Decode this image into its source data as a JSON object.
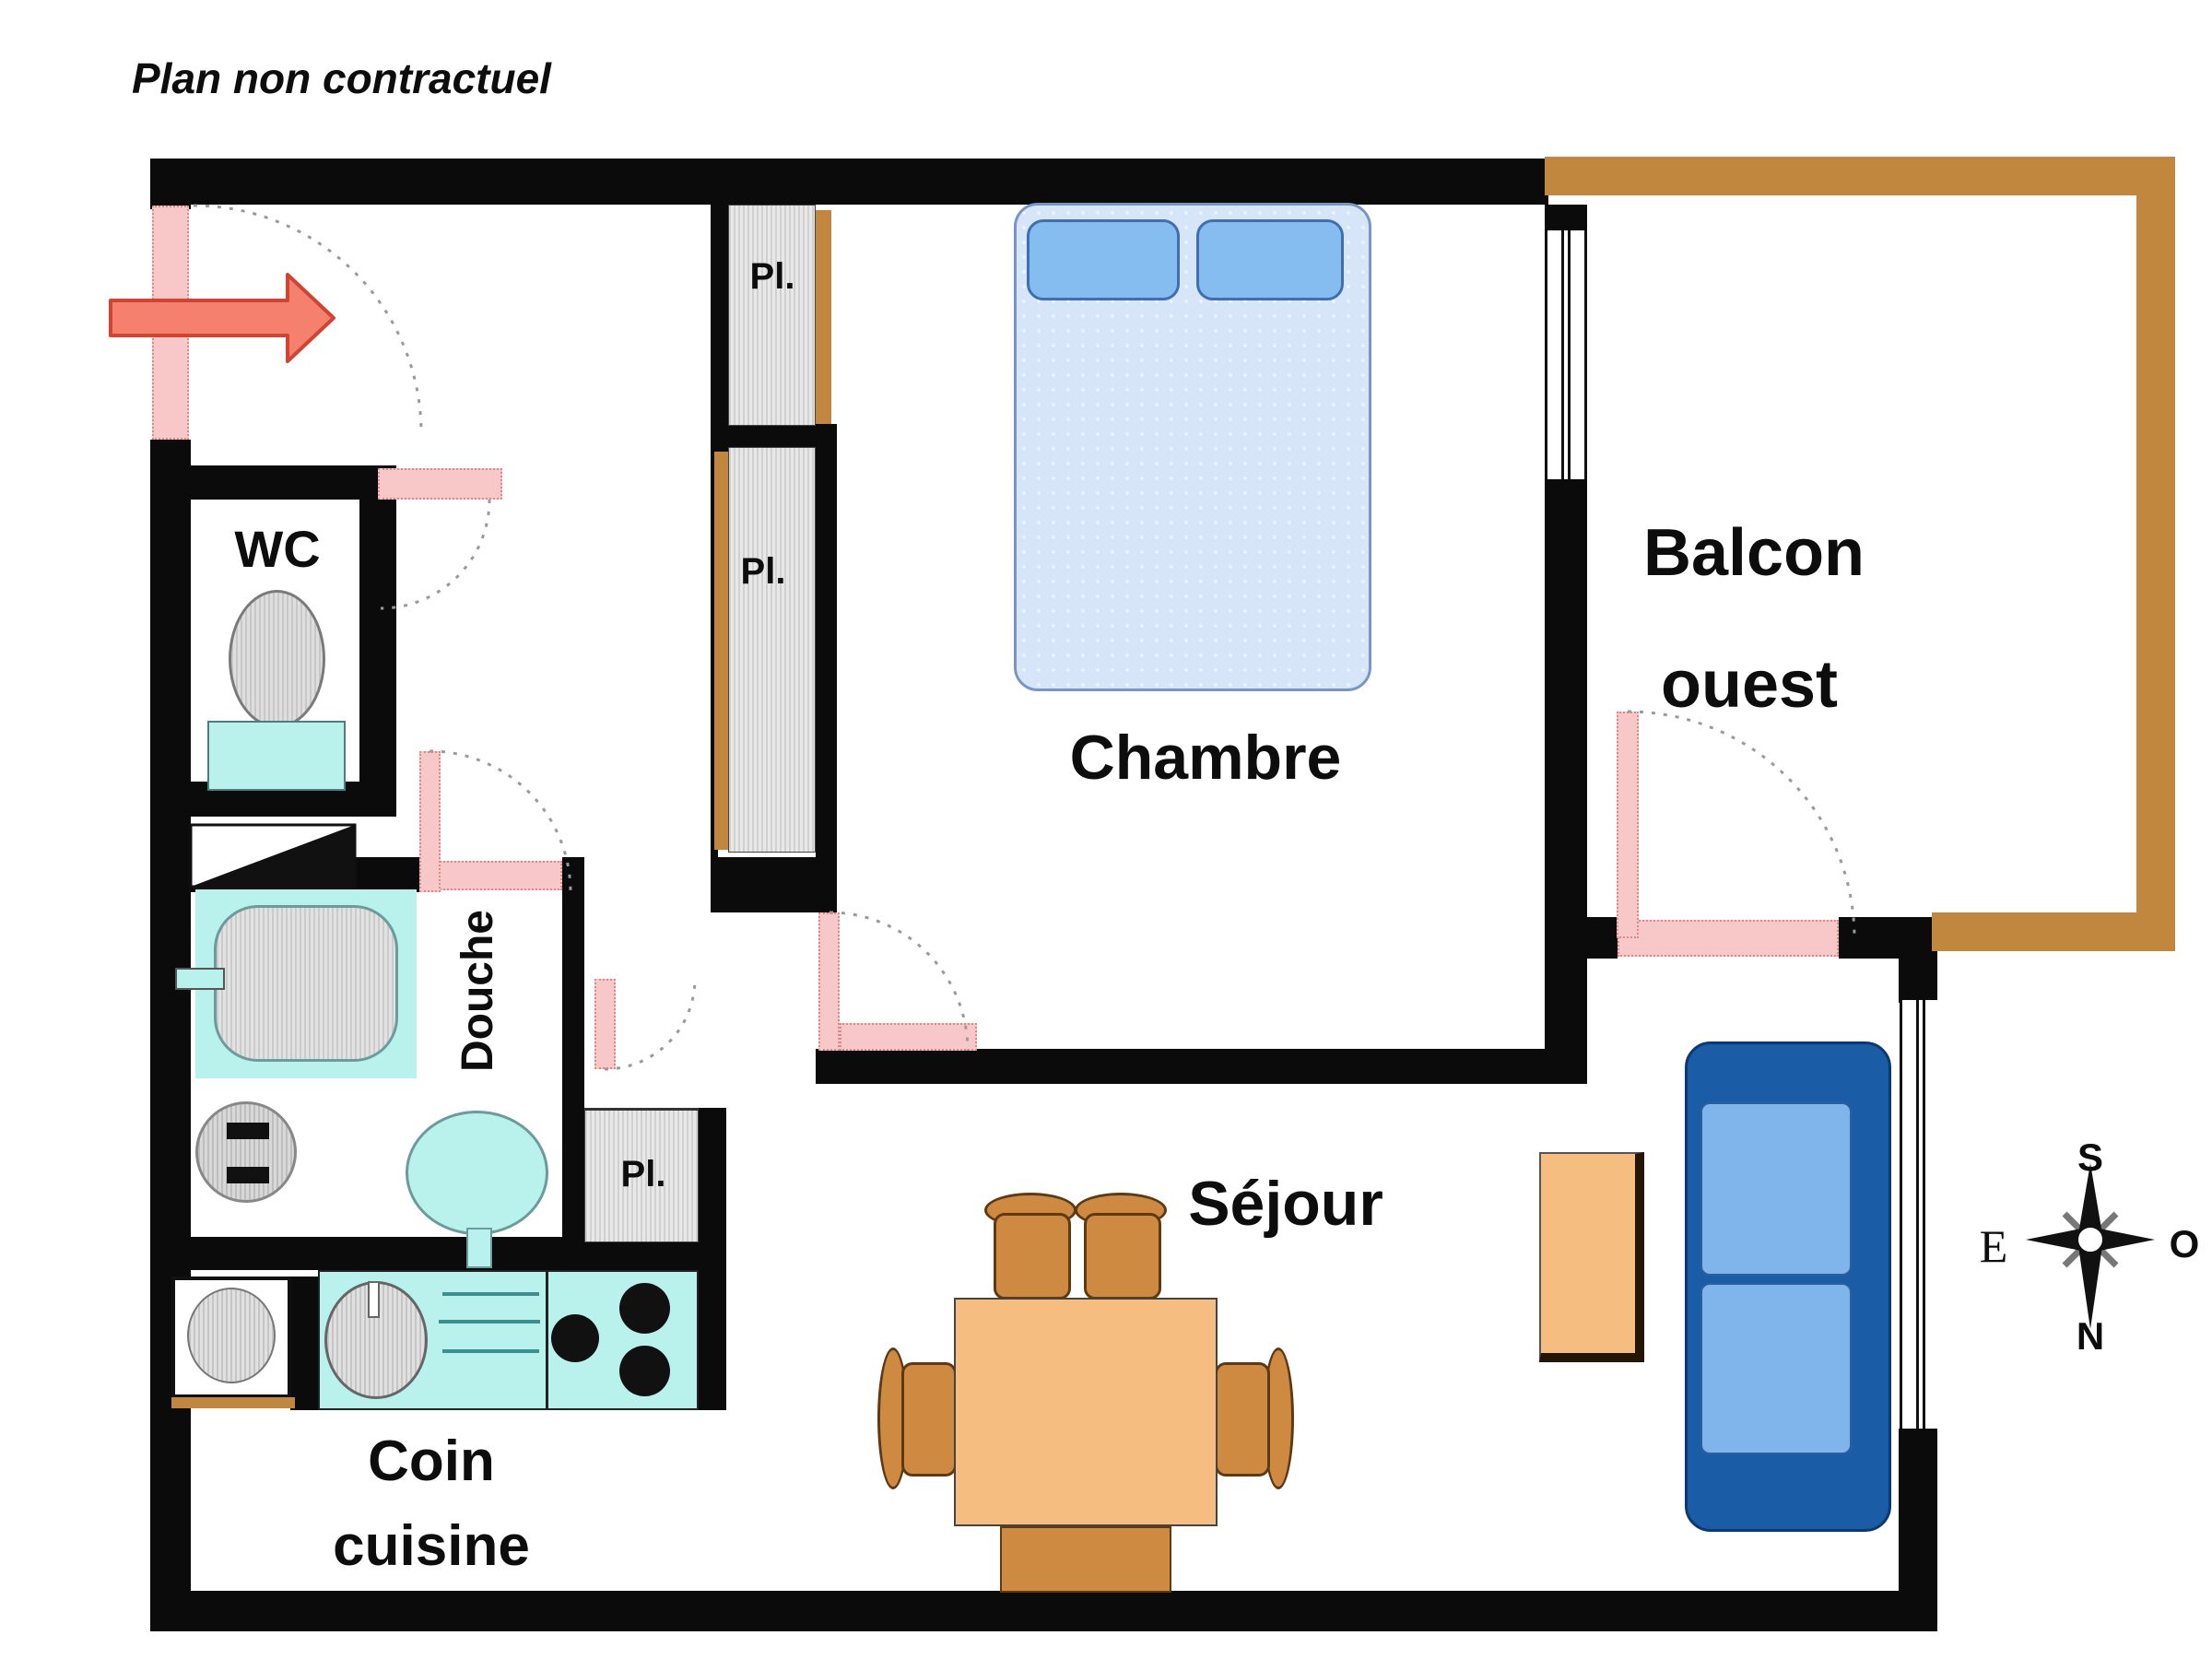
{
  "title": "Plan non contractuel",
  "rooms": {
    "wc": {
      "label": "WC"
    },
    "douche": {
      "label": "Douche"
    },
    "chambre": {
      "label": "Chambre"
    },
    "balcon": {
      "line1": "Balcon",
      "line2": "ouest"
    },
    "sejour": {
      "label": "Séjour"
    },
    "cuisine": {
      "line1": "Coin",
      "line2": "cuisine"
    }
  },
  "closets": {
    "entry_upper": "Pl.",
    "entry_lower": "Pl.",
    "sejour_small": "Pl."
  },
  "compass": {
    "south": "S",
    "north": "N",
    "east": "E",
    "west": "O"
  },
  "colors": {
    "wall": "#0b0b0b",
    "door_pink": "#f8c8c8",
    "balcony_brown": "#c1873e",
    "fixture_cyan": "#b9f1ec",
    "closet_gray": "#e8e8e8",
    "bed_blue": "#d6e6f8",
    "pillow_blue": "#85bdf0",
    "sofa_frame_blue": "#1b5ca6",
    "sofa_cushion_blue": "#7fb5ea",
    "table_orange": "#f6bd80",
    "chair_orange": "#cf8a42",
    "entry_arrow_red": "#f5806d"
  }
}
